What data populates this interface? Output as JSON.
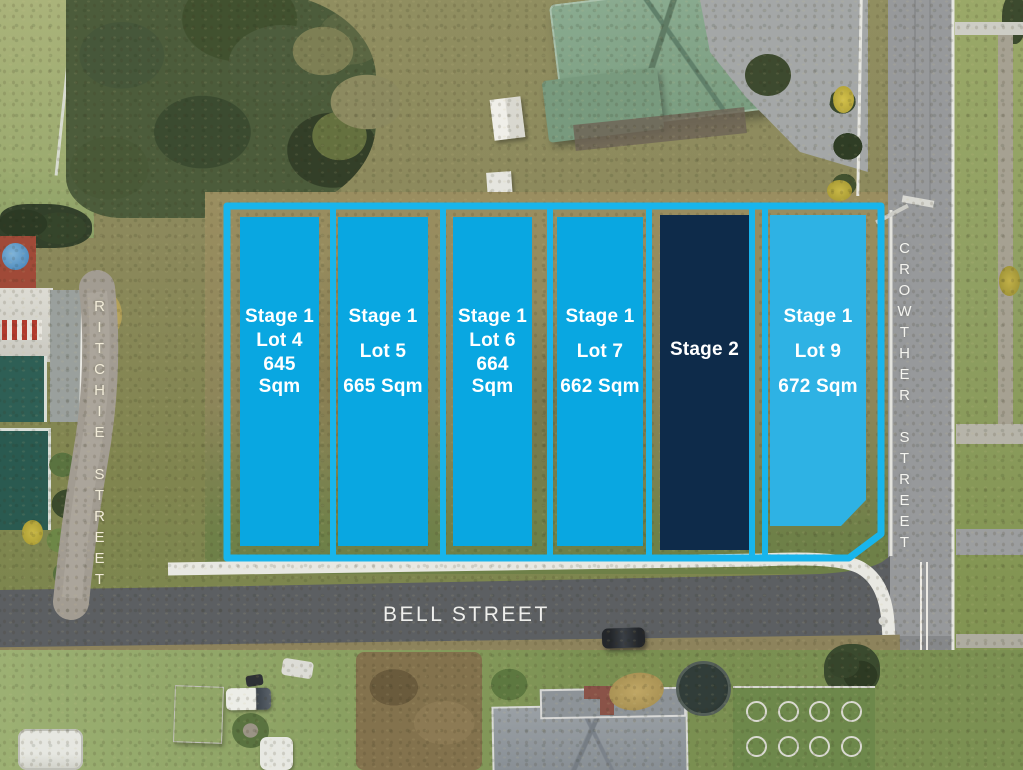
{
  "overlay": {
    "colors": {
      "stroke": "#18b5ec",
      "lot-fill": "#09a7e1",
      "lot9-fill": "#2eb2e4",
      "stage2-fill": "#0e2b4a",
      "label": "#ffffff"
    },
    "lots": [
      {
        "id": "lot-4",
        "stage": "Stage 1",
        "lot": "Lot 4",
        "area": "645 Sqm"
      },
      {
        "id": "lot-5",
        "stage": "Stage 1",
        "lot": "Lot 5",
        "area": "665 Sqm"
      },
      {
        "id": "lot-6",
        "stage": "Stage 1",
        "lot": "Lot 6",
        "area": "664 Sqm"
      },
      {
        "id": "lot-7",
        "stage": "Stage 1",
        "lot": "Lot 7",
        "area": "662 Sqm"
      },
      {
        "id": "stage-2",
        "stage": "Stage 2"
      },
      {
        "id": "lot-9",
        "stage": "Stage 1",
        "lot": "Lot 9",
        "area": "672 Sqm"
      }
    ]
  },
  "streets": {
    "ritchie": "RITCHIE STREET",
    "crowther": "CROWTHER STREET",
    "bell": "BELL STREET"
  }
}
